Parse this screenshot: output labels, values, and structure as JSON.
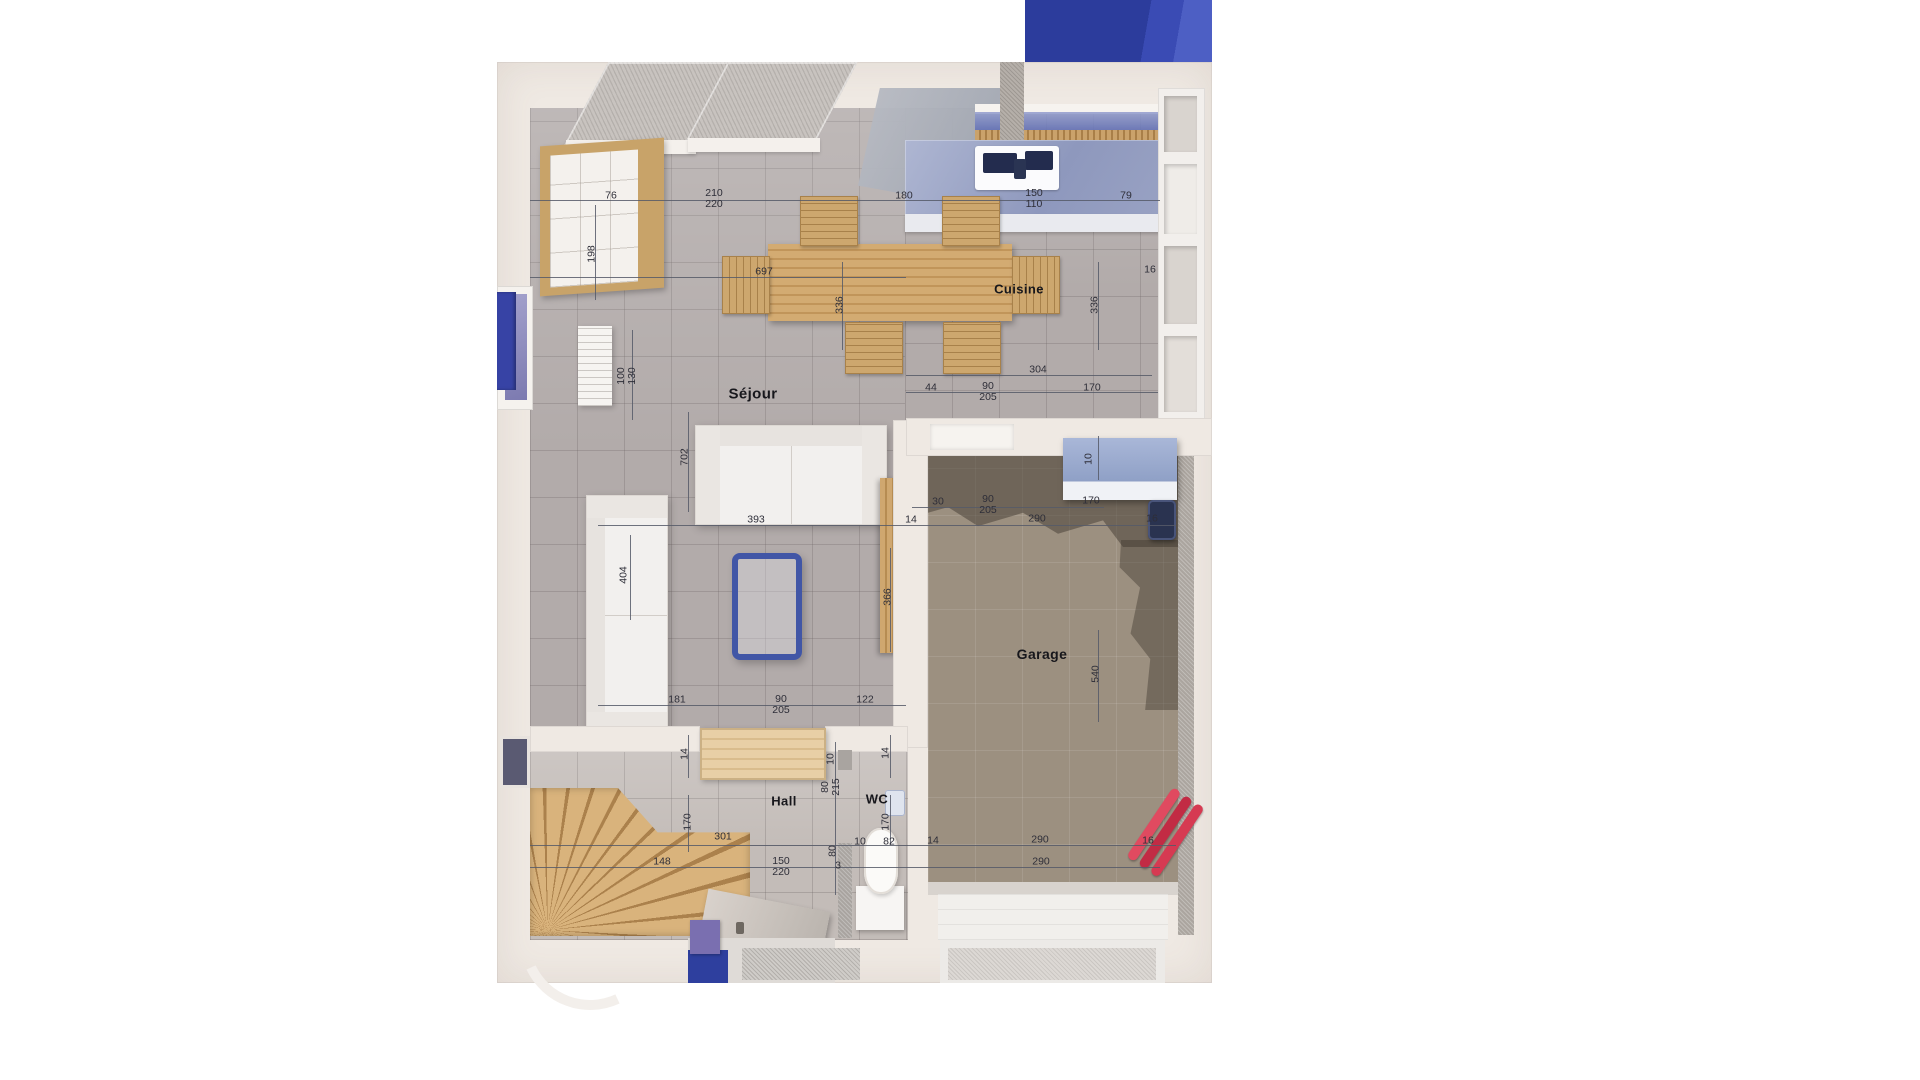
{
  "rooms": [
    {
      "name": "Séjour",
      "x": 753,
      "y": 394,
      "size": 15
    },
    {
      "name": "Cuisine",
      "x": 1019,
      "y": 289,
      "size": 13
    },
    {
      "name": "Garage",
      "x": 1042,
      "y": 654,
      "size": 14
    },
    {
      "name": "Hall",
      "x": 784,
      "y": 801,
      "size": 13
    },
    {
      "name": "WC",
      "x": 877,
      "y": 799,
      "size": 13
    }
  ],
  "dimensions": [
    {
      "lines": [
        "76"
      ],
      "x": 611,
      "y": 196
    },
    {
      "lines": [
        "210",
        "220"
      ],
      "x": 714,
      "y": 199
    },
    {
      "lines": [
        "180"
      ],
      "x": 904,
      "y": 196
    },
    {
      "lines": [
        "150",
        "110"
      ],
      "x": 1034,
      "y": 199
    },
    {
      "lines": [
        "79"
      ],
      "x": 1126,
      "y": 196
    },
    {
      "lines": [
        "198"
      ],
      "x": 592,
      "y": 254,
      "rot": -90
    },
    {
      "lines": [
        "697"
      ],
      "x": 764,
      "y": 272
    },
    {
      "lines": [
        "336"
      ],
      "x": 840,
      "y": 305,
      "rot": -90
    },
    {
      "lines": [
        "16"
      ],
      "x": 1150,
      "y": 270
    },
    {
      "lines": [
        "336"
      ],
      "x": 1095,
      "y": 305,
      "rot": -90
    },
    {
      "lines": [
        "100",
        "130"
      ],
      "x": 627,
      "y": 376,
      "rot": -90
    },
    {
      "lines": [
        "304"
      ],
      "x": 1038,
      "y": 370
    },
    {
      "lines": [
        "44"
      ],
      "x": 931,
      "y": 388
    },
    {
      "lines": [
        "90",
        "205"
      ],
      "x": 988,
      "y": 392
    },
    {
      "lines": [
        "170"
      ],
      "x": 1092,
      "y": 388
    },
    {
      "lines": [
        "702"
      ],
      "x": 685,
      "y": 457,
      "rot": -90
    },
    {
      "lines": [
        "10"
      ],
      "x": 1089,
      "y": 459,
      "rot": -90
    },
    {
      "lines": [
        "393"
      ],
      "x": 756,
      "y": 520
    },
    {
      "lines": [
        "14"
      ],
      "x": 911,
      "y": 520
    },
    {
      "lines": [
        "30"
      ],
      "x": 938,
      "y": 502
    },
    {
      "lines": [
        "90",
        "205"
      ],
      "x": 988,
      "y": 505
    },
    {
      "lines": [
        "170"
      ],
      "x": 1091,
      "y": 501
    },
    {
      "lines": [
        "290"
      ],
      "x": 1037,
      "y": 519
    },
    {
      "lines": [
        "16"
      ],
      "x": 1152,
      "y": 519
    },
    {
      "lines": [
        "404"
      ],
      "x": 624,
      "y": 575,
      "rot": -90
    },
    {
      "lines": [
        "366"
      ],
      "x": 888,
      "y": 597,
      "rot": -90
    },
    {
      "lines": [
        "540"
      ],
      "x": 1096,
      "y": 674,
      "rot": -90
    },
    {
      "lines": [
        "181"
      ],
      "x": 677,
      "y": 700
    },
    {
      "lines": [
        "90",
        "205"
      ],
      "x": 781,
      "y": 705
    },
    {
      "lines": [
        "122"
      ],
      "x": 865,
      "y": 700
    },
    {
      "lines": [
        "14"
      ],
      "x": 685,
      "y": 754,
      "rot": -90
    },
    {
      "lines": [
        "10"
      ],
      "x": 831,
      "y": 759,
      "rot": -90
    },
    {
      "lines": [
        "80",
        "215"
      ],
      "x": 831,
      "y": 787,
      "rot": -90
    },
    {
      "lines": [
        "14"
      ],
      "x": 886,
      "y": 753,
      "rot": -90
    },
    {
      "lines": [
        "170"
      ],
      "x": 688,
      "y": 822,
      "rot": -90
    },
    {
      "lines": [
        "301"
      ],
      "x": 723,
      "y": 837
    },
    {
      "lines": [
        "170"
      ],
      "x": 886,
      "y": 822,
      "rot": -90
    },
    {
      "lines": [
        "148"
      ],
      "x": 662,
      "y": 862
    },
    {
      "lines": [
        "150",
        "220"
      ],
      "x": 781,
      "y": 867
    },
    {
      "lines": [
        "80"
      ],
      "x": 833,
      "y": 851,
      "rot": -90
    },
    {
      "lines": [
        "3"
      ],
      "x": 838,
      "y": 866
    },
    {
      "lines": [
        "10"
      ],
      "x": 860,
      "y": 842
    },
    {
      "lines": [
        "82"
      ],
      "x": 889,
      "y": 842
    },
    {
      "lines": [
        "14"
      ],
      "x": 933,
      "y": 841
    },
    {
      "lines": [
        "290"
      ],
      "x": 1040,
      "y": 840
    },
    {
      "lines": [
        "16"
      ],
      "x": 1148,
      "y": 841
    },
    {
      "lines": [
        "290"
      ],
      "x": 1041,
      "y": 862
    }
  ],
  "colors": {
    "wall": "#efe9e3",
    "floor_living": "#b2abaa",
    "floor_hall": "#c3bcb8",
    "floor_garage": "#9c9080",
    "garage_shadow": "#3e362e",
    "kitchen_counter": "#99a2c1",
    "sink_basin": "#232c4e",
    "wood": "#cfa76f",
    "accent_blue": "#2e3f9e",
    "glass_table_blue": "#4156a6",
    "pipe_red": "#d8435c",
    "dimension_line": "#565b68",
    "label_text": "#17171c"
  }
}
